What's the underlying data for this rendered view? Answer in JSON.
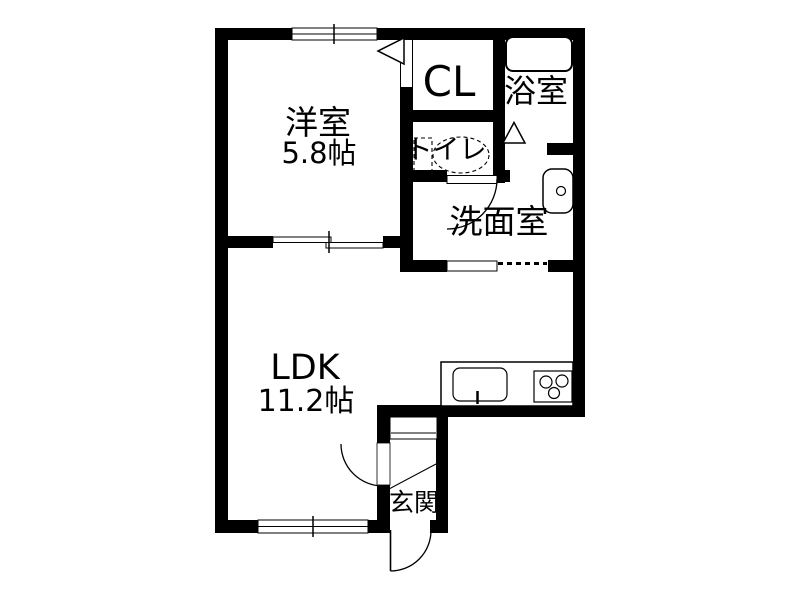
{
  "colors": {
    "wall": "#000000",
    "background": "#ffffff",
    "line": "#000000"
  },
  "rooms": {
    "western": {
      "label": "洋室",
      "area": "5.8帖"
    },
    "closet": {
      "label": "CL"
    },
    "bathroom": {
      "label": "浴室"
    },
    "toilet": {
      "label": "トイレ"
    },
    "washroom": {
      "label": "洗面室"
    },
    "ldk": {
      "label": "LDK",
      "area": "11.2帖"
    },
    "entrance": {
      "label": "玄関"
    }
  },
  "fixtures": {
    "bathtub": "bathtub-icon",
    "wash_basin": "wash-basin-icon",
    "toilet_bowl": "toilet-bowl-icon",
    "kitchen_counter": "kitchen-counter-icon",
    "kitchen_sink": "kitchen-sink-icon",
    "gas_stove": "gas-stove-icon",
    "shoe_cabinet": "shoe-cabinet-icon"
  },
  "openings": {
    "western_window": "sliding-window",
    "ldk_window": "sliding-window",
    "western_ldk_door": "double-sliding-door",
    "closet_door": "folding-door",
    "bathroom_door": "folding-door",
    "toilet_door": "hinged-door",
    "washroom_door": "pocket-sliding-door",
    "entrance_inner_door": "hinged-door",
    "entrance_door": "hinged-door"
  }
}
